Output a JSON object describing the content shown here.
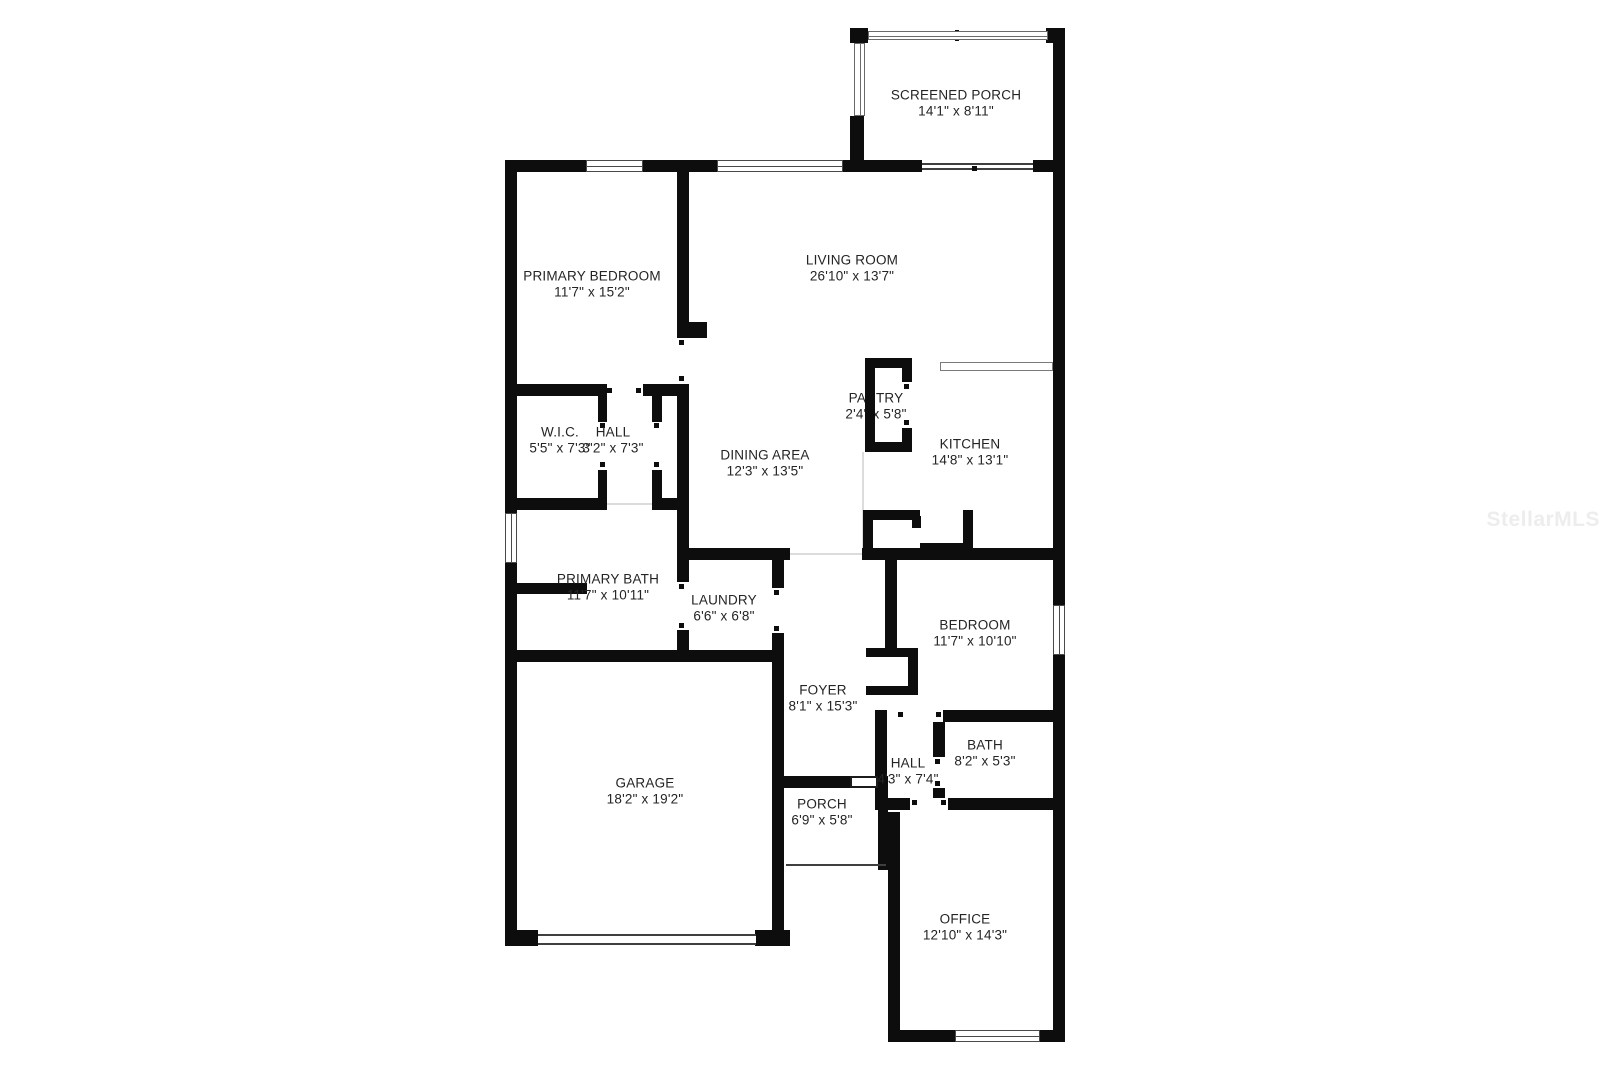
{
  "watermark": {
    "text": "StellarMLS"
  },
  "colors": {
    "wall": "#0d0d0d",
    "background": "#ffffff",
    "label_text": "#242424",
    "watermark": "#ededed"
  },
  "rooms": {
    "screened_porch": {
      "name": "SCREENED PORCH",
      "dims": "14'1\" x 8'11\""
    },
    "primary_bedroom": {
      "name": "PRIMARY BEDROOM",
      "dims": "11'7\" x 15'2\""
    },
    "living_room": {
      "name": "LIVING ROOM",
      "dims": "26'10\" x 13'7\""
    },
    "pantry": {
      "name": "PANTRY",
      "dims": "2'4\" x 5'8\""
    },
    "wic": {
      "name": "W.I.C.",
      "dims": "5'5\" x 7'3\""
    },
    "hall_upper": {
      "name": "HALL",
      "dims": "3'2\" x 7'3\""
    },
    "dining_area": {
      "name": "DINING AREA",
      "dims": "12'3\" x 13'5\""
    },
    "kitchen": {
      "name": "KITCHEN",
      "dims": "14'8\" x 13'1\""
    },
    "primary_bath": {
      "name": "PRIMARY BATH",
      "dims": "11'7\" x 10'11\""
    },
    "laundry": {
      "name": "LAUNDRY",
      "dims": "6'6\" x 6'8\""
    },
    "bedroom": {
      "name": "BEDROOM",
      "dims": "11'7\" x 10'10\""
    },
    "foyer": {
      "name": "FOYER",
      "dims": "8'1\" x 15'3\""
    },
    "bath": {
      "name": "BATH",
      "dims": "8'2\" x 5'3\""
    },
    "hall_lower": {
      "name": "HALL",
      "dims": "4'3\" x 7'4\""
    },
    "garage": {
      "name": "GARAGE",
      "dims": "18'2\" x 19'2\""
    },
    "porch": {
      "name": "PORCH",
      "dims": "6'9\" x 5'8\""
    },
    "office": {
      "name": "OFFICE",
      "dims": "12'10\" x 14'3\""
    }
  }
}
